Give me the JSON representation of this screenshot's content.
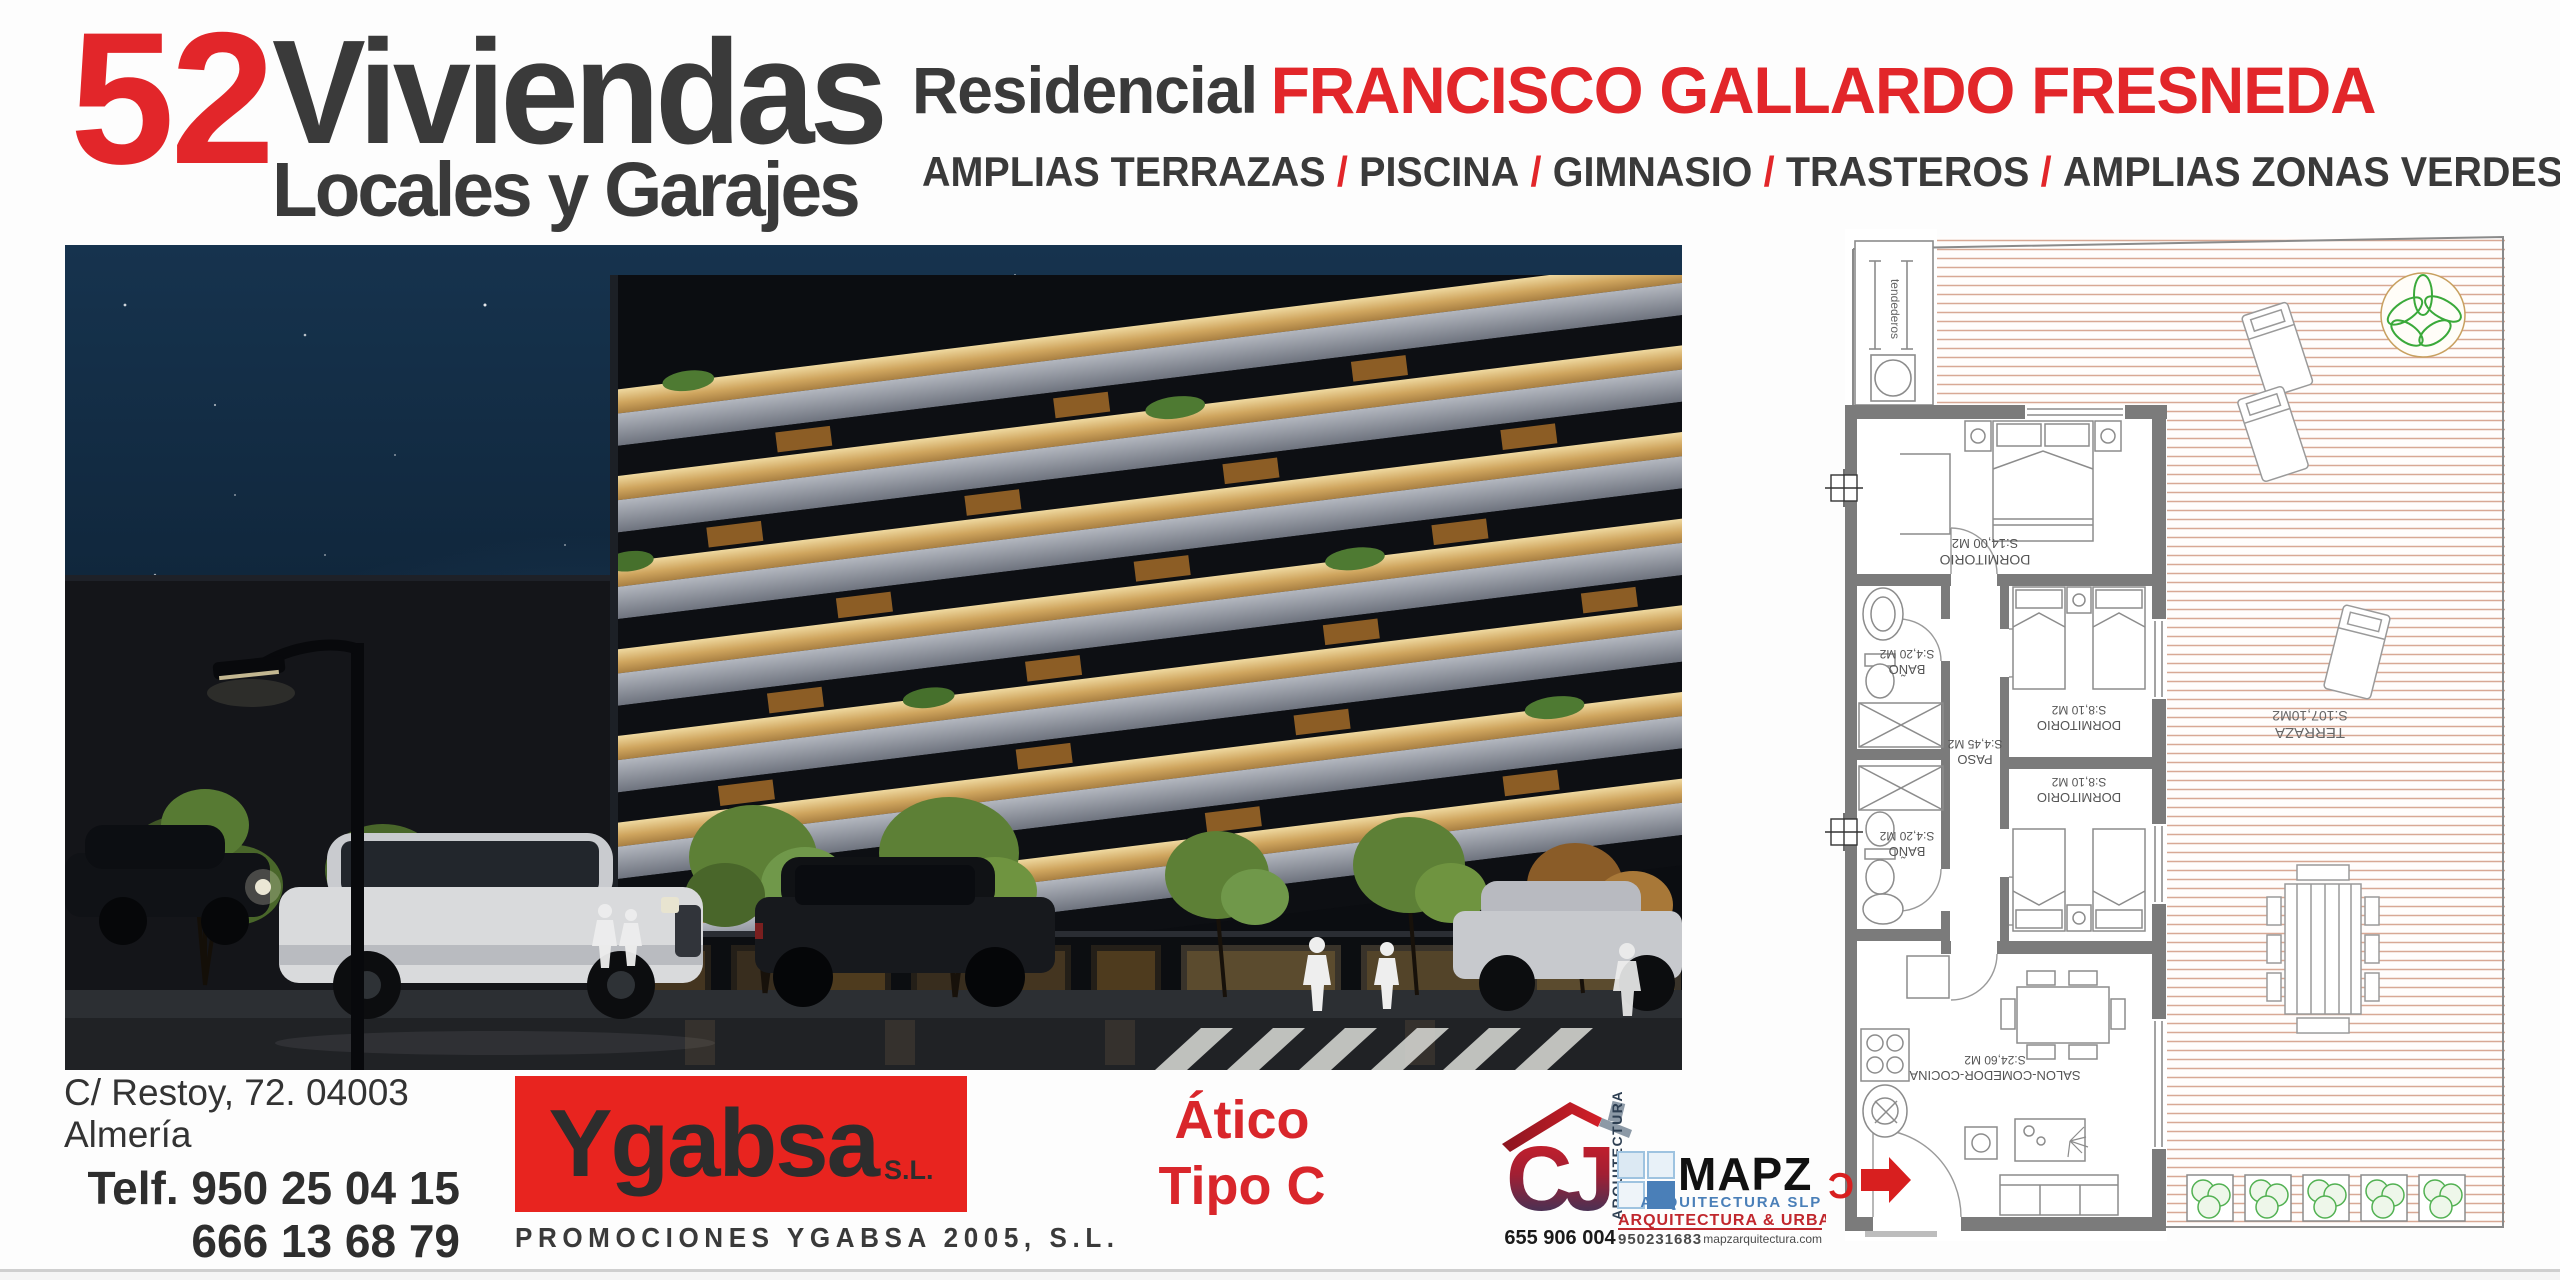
{
  "header": {
    "units_number": "52",
    "units_title": "Viviendas",
    "units_subtitle": "Locales y Garajes",
    "residencial_prefix": "Residencial",
    "residencial_name": "FRANCISCO GALLARDO FRESNEDA",
    "separator": "/",
    "features": [
      "AMPLIAS TERRAZAS",
      "PISCINA",
      "GIMNASIO",
      "TRASTEROS",
      "AMPLIAS ZONAS VERDES"
    ]
  },
  "contact": {
    "address": "C/ Restoy, 72. 04003 Almería",
    "phone1": "Telf. 950 25 04 15",
    "phone2": "666 13 68 79",
    "email": "ygabsa2005@hotmail.com"
  },
  "developer": {
    "brand": "Ygabsa",
    "brand_suffix": "S.L.",
    "tagline": "PROMOCIONES YGABSA 2005, S.L."
  },
  "unit": {
    "line1": "Ático",
    "line2": "Tipo C"
  },
  "architects": {
    "cj": {
      "initials": "CJ",
      "vertical": "ARQUITECTURA",
      "phone": "655 906 004"
    },
    "mapz": {
      "name": "MAPZ",
      "subtitle": "ARQUITECTURA SLP",
      "tagline": "ARQUITECTURA & URBANISMO",
      "phone": "950231683",
      "website": "mapzarquitectura.com"
    }
  },
  "floorplan": {
    "terraza": {
      "name": "TERRAZA",
      "area": "S:107,10M2"
    },
    "tendederos": "tendederos",
    "dorm_main": {
      "name": "DORMITORIO",
      "area": "S:14,00 M2"
    },
    "dorm_a": {
      "name": "DORMITORIO",
      "area": "S:8,10 M2"
    },
    "dorm_b": {
      "name": "DORMITORIO",
      "area": "S:8,10 M2"
    },
    "bano_1": {
      "name": "BAÑO",
      "area": "S:4,20 M2"
    },
    "bano_2": {
      "name": "BAÑO",
      "area": "S:4,20 M2"
    },
    "paso": {
      "name": "PASO",
      "area": "S:4,45 M2"
    },
    "salon": {
      "name": "SALON-COMEDOR-COCINA",
      "area": "S:24,60 M2"
    },
    "entry_label": "C"
  },
  "colors": {
    "accent_red": "#e2262a",
    "dark_text": "#3a3a3a",
    "mapz_blue": "#4a7fb8"
  }
}
